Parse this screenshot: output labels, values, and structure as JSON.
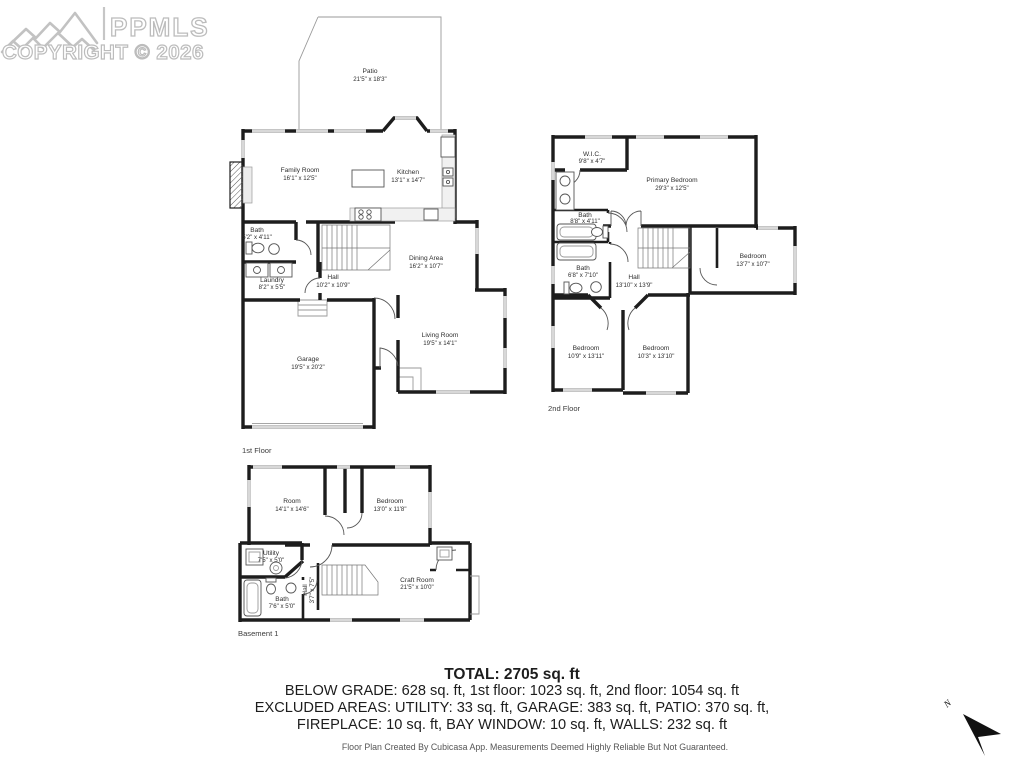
{
  "logo": {
    "brand": "PPMLS",
    "copyright": "COPYRIGHT © 2026"
  },
  "floors": {
    "first": {
      "label": "1st Floor",
      "rooms": {
        "patio": {
          "name": "Patio",
          "dims": "21'5\" x 18'3\""
        },
        "family": {
          "name": "Family Room",
          "dims": "16'1\" x 12'5\""
        },
        "kitchen": {
          "name": "Kitchen",
          "dims": "13'1\" x 14'7\""
        },
        "bath": {
          "name": "Bath",
          "dims": "5'2\" x 4'11\""
        },
        "laundry": {
          "name": "Laundry",
          "dims": "8'2\" x 5'5\""
        },
        "hall": {
          "name": "Hall",
          "dims": "10'2\" x 10'9\""
        },
        "dining": {
          "name": "Dining Area",
          "dims": "16'2\" x 10'7\""
        },
        "living": {
          "name": "Living Room",
          "dims": "19'5\" x 14'1\""
        },
        "garage": {
          "name": "Garage",
          "dims": "19'5\" x 20'2\""
        }
      }
    },
    "second": {
      "label": "2nd Floor",
      "rooms": {
        "wic": {
          "name": "W.I.C.",
          "dims": "9'8\" x 4'7\""
        },
        "primary": {
          "name": "Primary Bedroom",
          "dims": "29'3\" x 12'5\""
        },
        "bath1": {
          "name": "Bath",
          "dims": "8'8\" x 4'11\""
        },
        "bath2": {
          "name": "Bath",
          "dims": "6'8\" x 7'10\""
        },
        "hall": {
          "name": "Hall",
          "dims": "13'10\" x 13'9\""
        },
        "bed_right": {
          "name": "Bedroom",
          "dims": "13'7\" x 10'7\""
        },
        "bed_left": {
          "name": "Bedroom",
          "dims": "10'9\" x 13'11\""
        },
        "bed_mid": {
          "name": "Bedroom",
          "dims": "10'3\" x 13'10\""
        }
      }
    },
    "basement": {
      "label": "Basement 1",
      "rooms": {
        "room": {
          "name": "Room",
          "dims": "14'1\" x 14'6\""
        },
        "bedroom": {
          "name": "Bedroom",
          "dims": "13'0\" x 11'8\""
        },
        "utility": {
          "name": "Utility",
          "dims": "7'5\" x 5'0\""
        },
        "bath": {
          "name": "Bath",
          "dims": "7'6\" x 5'0\""
        },
        "hall": {
          "name": "Hall",
          "dims": "3'7\" x 7'5\""
        },
        "craft": {
          "name": "Craft Room",
          "dims": "21'5\" x 10'0\""
        }
      }
    }
  },
  "summary": {
    "total": "TOTAL: 2705 sq. ft",
    "line1": "BELOW GRADE: 628 sq. ft, 1st floor: 1023 sq. ft, 2nd floor: 1054 sq. ft",
    "line2": "EXCLUDED AREAS: UTILITY: 33 sq. ft, GARAGE: 383 sq. ft, PATIO: 370 sq. ft,",
    "line3": "FIREPLACE: 10 sq. ft, BAY WINDOW: 10 sq. ft, WALLS: 232 sq. ft"
  },
  "footer": "Floor Plan Created By Cubicasa App. Measurements Deemed Highly Reliable But Not Guaranteed.",
  "compass": {
    "label": "N"
  },
  "colors": {
    "wall": "#1d1d1d",
    "window": "#d8d8d8",
    "logo_gray": "#bcbcbc",
    "text": "#2e2e2e"
  }
}
